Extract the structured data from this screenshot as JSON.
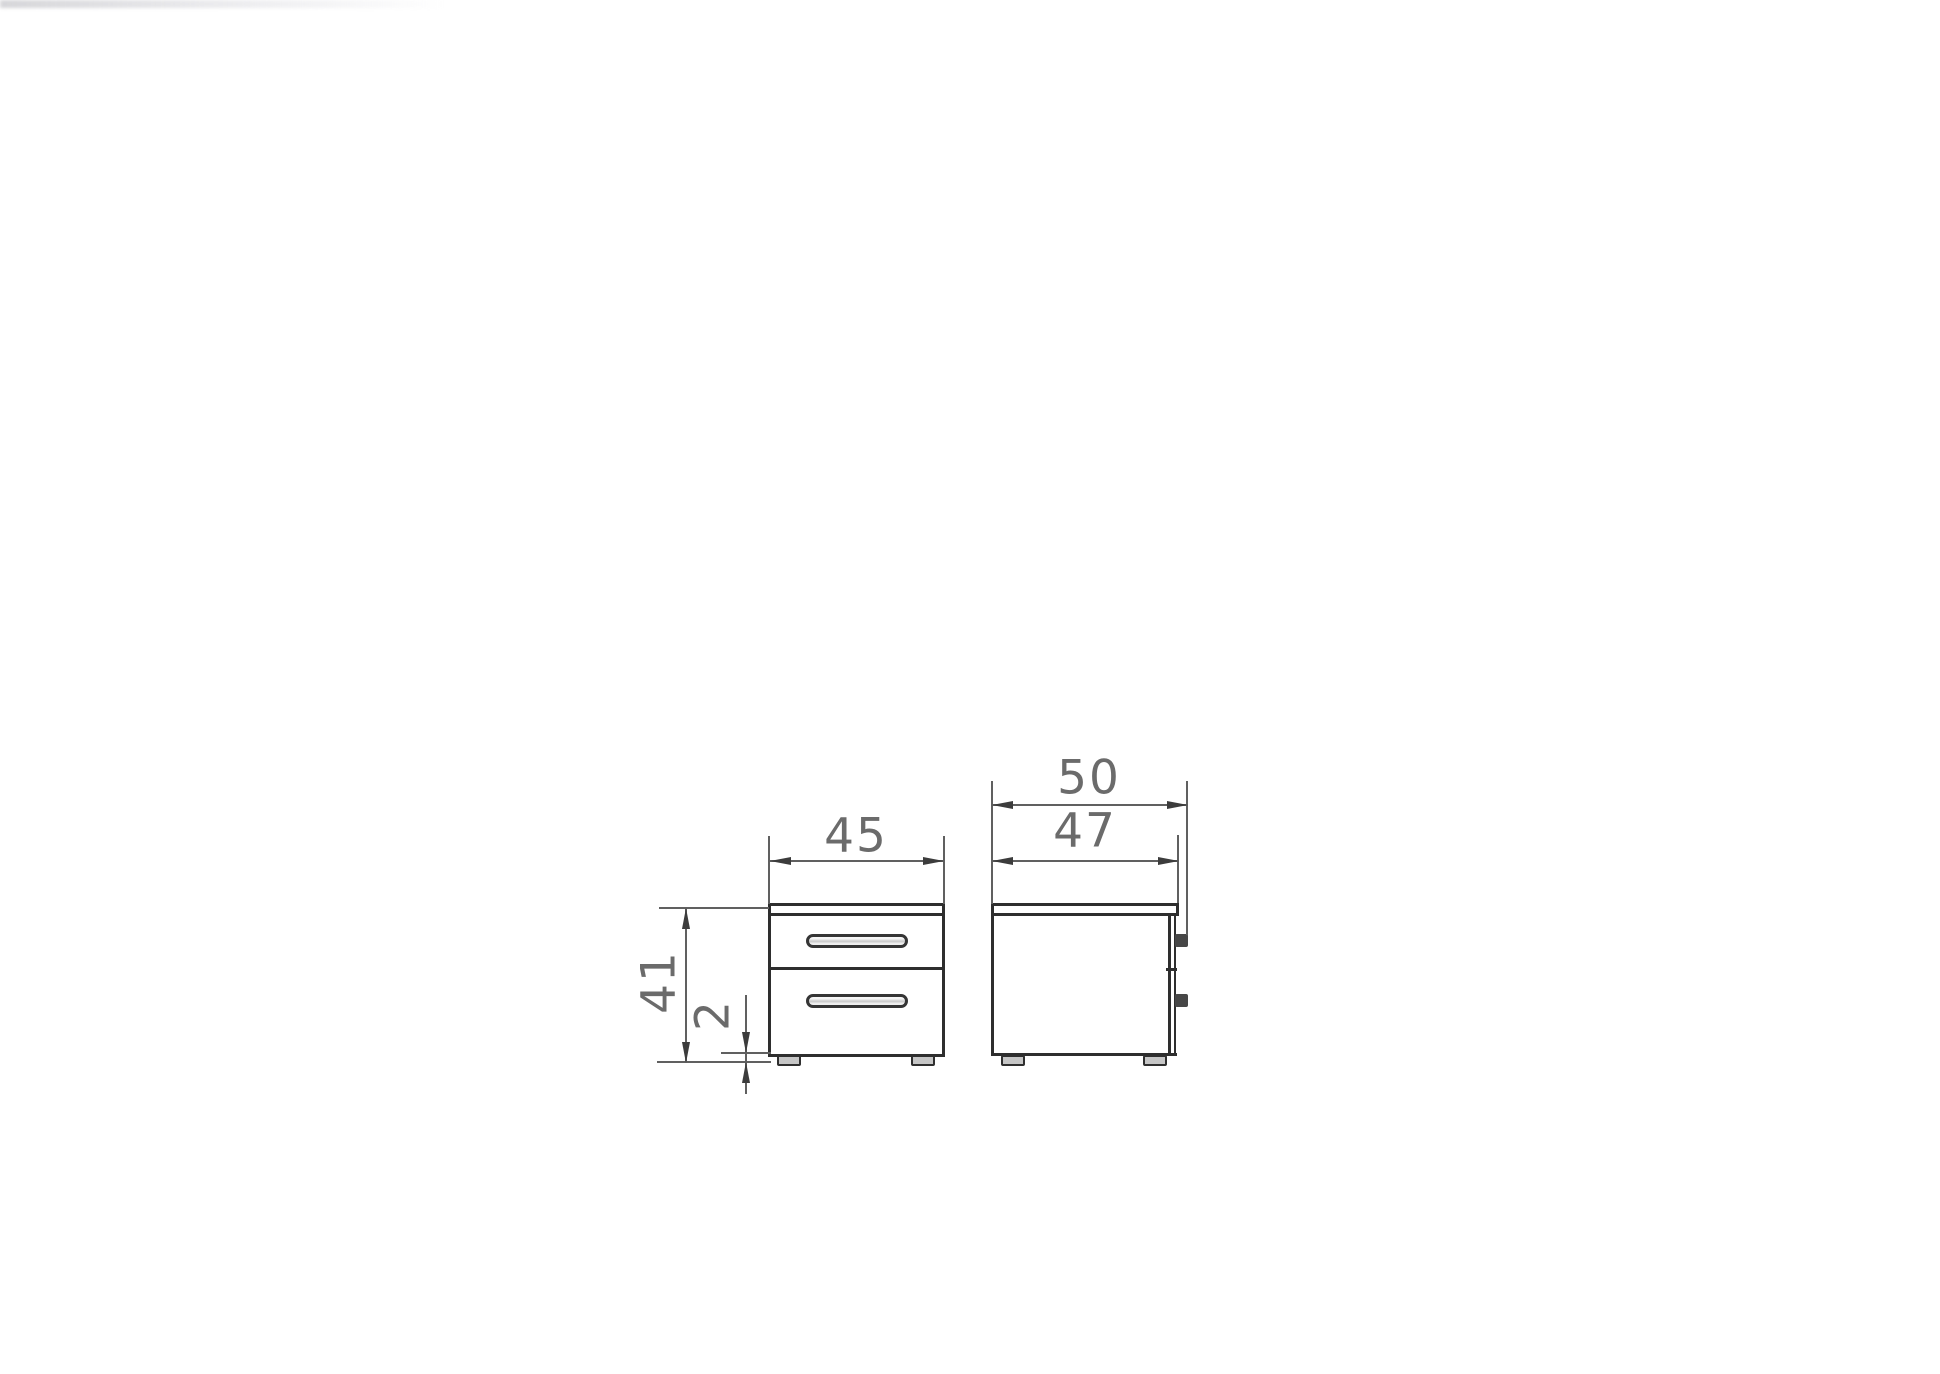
{
  "colors": {
    "background": "#ffffff",
    "outline": "#2e2e2e",
    "dimension_line": "#606060",
    "arrowhead": "#3c3c3c",
    "label_text": "#6b6b6b"
  },
  "labels": {
    "front_width": "45",
    "front_height": "41",
    "foot_height": "2",
    "side_depth_overall": "50",
    "side_depth_body": "47"
  },
  "dimensions": [
    {
      "id": "width",
      "label": "45",
      "value": 45,
      "view": "front",
      "axis": "horizontal"
    },
    {
      "id": "height",
      "label": "41",
      "value": 41,
      "view": "front",
      "axis": "vertical"
    },
    {
      "id": "foot-height",
      "label": "2",
      "value": 2,
      "view": "front",
      "axis": "vertical"
    },
    {
      "id": "depth-overall",
      "label": "50",
      "value": 50,
      "view": "side",
      "axis": "horizontal"
    },
    {
      "id": "depth-body",
      "label": "47",
      "value": 47,
      "view": "side",
      "axis": "horizontal"
    }
  ],
  "views": {
    "front": {
      "drawer_count": 2,
      "handle_count": 2,
      "feet_count": 2
    },
    "side": {
      "handle_profile_count": 2,
      "feet_count": 2
    }
  }
}
